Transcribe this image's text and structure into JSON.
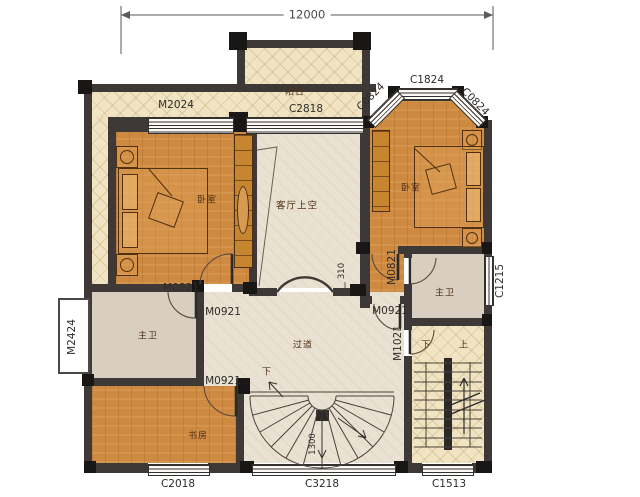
{
  "plan": {
    "total_width_dim": "12000",
    "rooms": {
      "balcony": "阳台",
      "living_void": "客厅上空",
      "bedroom": "卧室",
      "master_bath": "主卫",
      "corridor": "过道",
      "study": "书房"
    },
    "stairs": {
      "down": "下",
      "up": "上",
      "well_width_dim": "1300"
    },
    "dims": {
      "arch_offset": "310"
    },
    "openings": {
      "m2024": "M2024",
      "c2818": "C2818",
      "c1824": "C1824",
      "c0824": "C0824",
      "m0821": "M0821",
      "m0921": "M0921",
      "m1021": "M1021",
      "m2424": "M2424",
      "c1215": "C1215",
      "c2018": "C2018",
      "c3218": "C3218",
      "c1513": "C1513"
    },
    "colors": {
      "wall": "#3e3936",
      "wood_floor": "#cf8a41",
      "balcony_floor": "#f1e4c3",
      "hall_floor": "#e9e1d1",
      "bath_floor": "#d8cfc0"
    }
  }
}
